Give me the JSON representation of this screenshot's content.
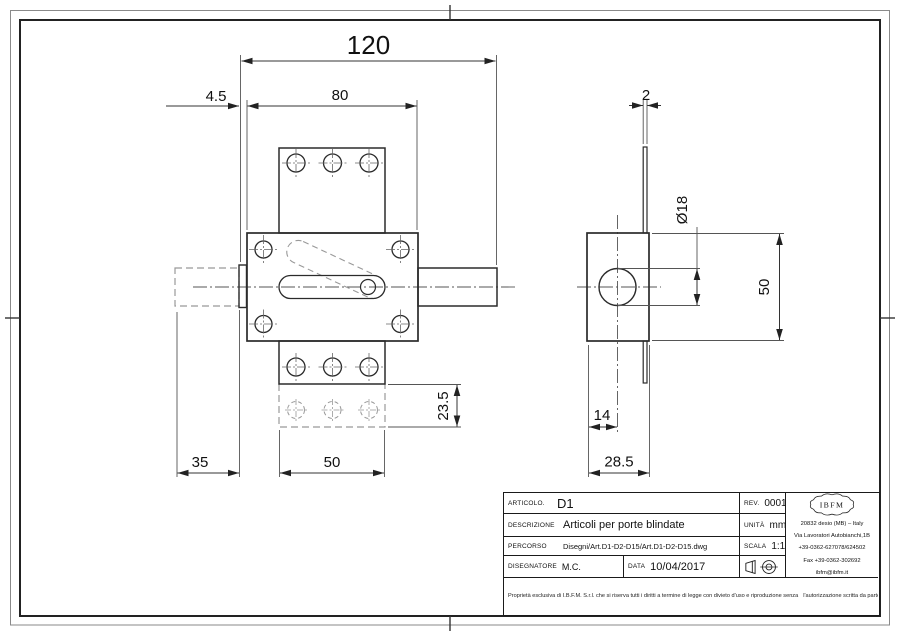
{
  "sheet": {
    "background": "#ffffff",
    "line_color": "#2b2b2b",
    "dashed_color": "#999999",
    "accent": "#1a1a1a"
  },
  "front_view": {
    "dims": {
      "total_length": "120",
      "faceplate_thickness": "4.5",
      "body_width": "80",
      "bolt_travel": "35",
      "plate_width": "50",
      "plate_extension": "23.5"
    }
  },
  "side_view": {
    "dims": {
      "plate_thickness": "2",
      "bolt_diameter": "Ø18",
      "body_height": "50",
      "hole_offset": "14",
      "body_depth": "28.5"
    }
  },
  "title_block": {
    "articolo_label": "ARTICOLO.",
    "articolo": "D1",
    "rev_label": "REV.",
    "rev": "0001",
    "descrizione_label": "DESCRIZIONE",
    "descrizione": "Articoli per porte blindate",
    "unita_label": "UNITÀ",
    "unita": "mm",
    "percorso_label": "PERCORSO",
    "percorso": "Disegni/Art.D1-D2-D15/Art.D1-D2-D15.dwg",
    "scala_label": "SCALA",
    "scala": "1:1",
    "disegnatore_label": "DISEGNATORE",
    "disegnatore": "M.C.",
    "data_label": "DATA",
    "data": "10/04/2017",
    "logo_text": "IBFM",
    "address": [
      "20832 desio (MB) – Italy",
      "Via Lavoratori Autobianchi,1B",
      "+39-0362-627078/624502",
      "Fax +39-0362-302692",
      "ibfm@ibfm.it"
    ],
    "disclaimer": [
      "Proprietà esclusiva di I.B.F.M. S.r.l. che si riserva tutti i diritti a termine di legge con divieto d'uso e riproduzione senza",
      "l'autorizzazione scritta da parte dell'azienda. I.B.F.M. S.r.l. si riserva il diritto di apportare modifiche senza preavviso e autonomamente.",
      "Exclusive property of I.B.F.M. S.r.l. which reserves all rights by law with the prohibition of use and reproduction without the written",
      "agreement of the company. I.B.F.M. S.r.l. reserves the right to make changes without any notification and independently."
    ]
  }
}
